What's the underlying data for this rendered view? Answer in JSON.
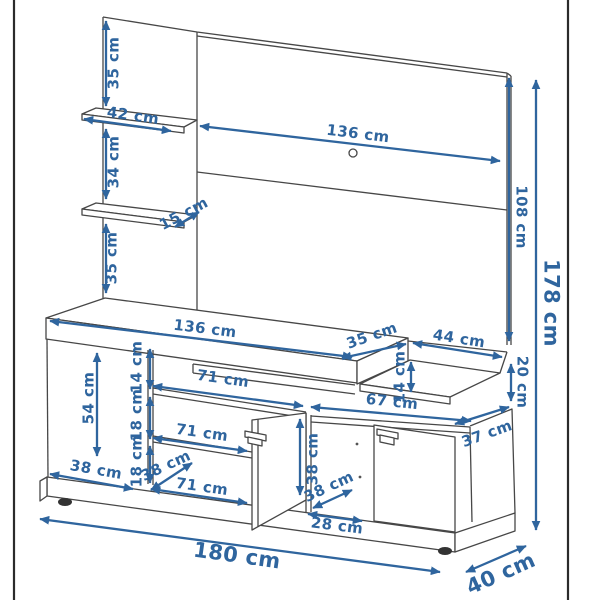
{
  "diagram": {
    "unit": "cm",
    "labels": [
      {
        "text": "35 cm"
      },
      {
        "text": "42 cm"
      },
      {
        "text": "34 cm"
      },
      {
        "text": "15 cm"
      },
      {
        "text": "35 cm"
      },
      {
        "text": "136 cm"
      },
      {
        "text": "108 cm"
      },
      {
        "text": "178 cm"
      },
      {
        "text": "136 cm"
      },
      {
        "text": "35 cm"
      },
      {
        "text": "44 cm"
      },
      {
        "text": "14 cm"
      },
      {
        "text": "20 cm"
      },
      {
        "text": "54 cm"
      },
      {
        "text": "14 cm"
      },
      {
        "text": "71 cm"
      },
      {
        "text": "18 cm"
      },
      {
        "text": "67 cm"
      },
      {
        "text": "37 cm"
      },
      {
        "text": "71 cm"
      },
      {
        "text": "38 cm"
      },
      {
        "text": "18 cm"
      },
      {
        "text": "38 cm"
      },
      {
        "text": "38 cm"
      },
      {
        "text": "71 cm"
      },
      {
        "text": "38 cm"
      },
      {
        "text": "28 cm"
      },
      {
        "text": "180 cm"
      },
      {
        "text": "40 cm"
      }
    ],
    "colors": {
      "dimension_blue": "#2f659e",
      "drawing_line": "#474747",
      "page_border": "#2b2b2b"
    }
  }
}
